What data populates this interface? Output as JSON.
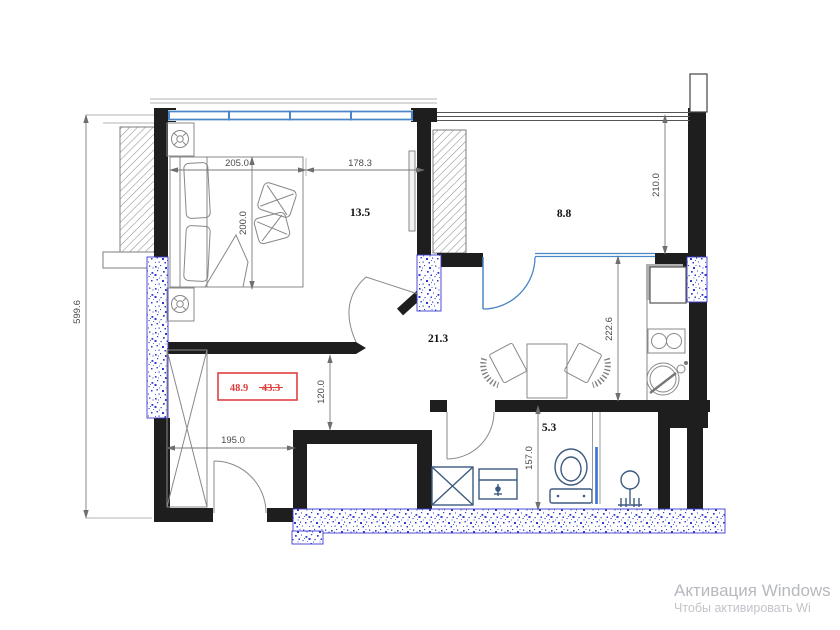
{
  "plan": {
    "areas": {
      "bedroom": "13.5",
      "top_right_room": "8.8",
      "living": "21.3",
      "bathroom": "5.3"
    },
    "total_area": {
      "current": "48.9",
      "previous": "43.3"
    },
    "dimensions": {
      "left_wall": "599.6",
      "bed_width": "205.0",
      "bedroom_right": "178.3",
      "bed_depth": "200.0",
      "top_right_room_depth": "210.0",
      "living_depth": "222.6",
      "hall_depth": "120.0",
      "hall_width": "195.0",
      "bathroom_depth": "157.0"
    }
  },
  "watermark": {
    "title": "Активация Windows",
    "subtitle": "Чтобы активировать Wi"
  },
  "colors": {
    "wall_black": "#1e1e1e",
    "window_blue": "#4a86c8",
    "fixture_blue": "#3d5a80",
    "speckle_blue": "#2b3bd0",
    "dimension_gray": "#7a7a7a",
    "alert_red": "#e03c3c",
    "watermark_gray": "#b6b9be"
  }
}
